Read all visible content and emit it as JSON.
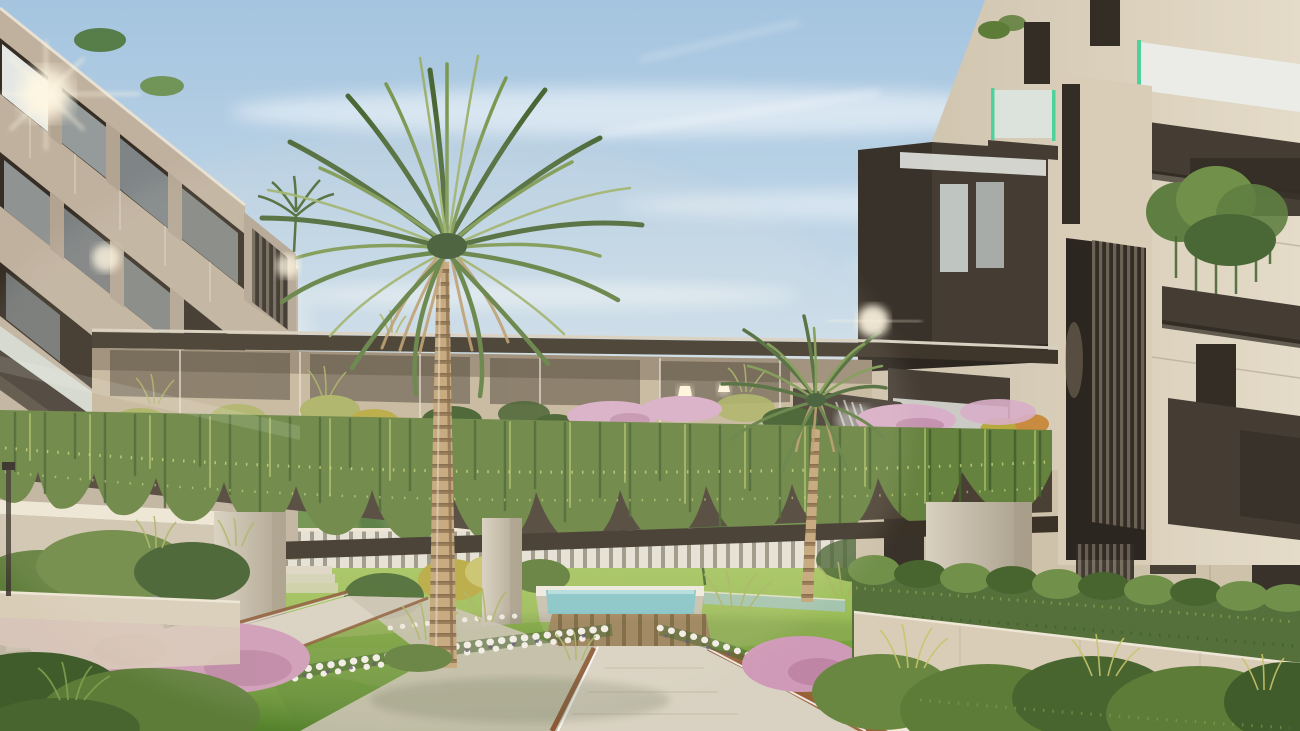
{
  "meta": {
    "type": "architectural-rendering",
    "subject": "Modern residential complex courtyard with landscaped garden, green bridge and palm trees",
    "style": "photorealistic 3D exterior visualization",
    "lighting": "warm late-afternoon sun from the left",
    "width_px": 1300,
    "height_px": 731
  },
  "scene": {
    "description": "Photorealistic rendering of a contemporary apartment development: two beige-and-charcoal buildings linked by a planted pergola bridge draped with hanging vines, a tall date palm rising through the courtyard, landscaped paths with corten-steel edging and lit borders, a turquoise water feature with timber deck, white and pink flower beds, ornamental grasses and clipped hedges.",
    "labels": {
      "sky": "Sky with wispy clouds",
      "clouds": "Cloud streaks",
      "sun_flares": "Sun glints on facades",
      "left_building": "Left apartment building",
      "left_wing": "Left single-storey wing",
      "roof_plants": "Rooftop planting",
      "bridge": "Planted pergola bridge",
      "pergola": "Pergola canopy",
      "stone_wall": "Stone feature wall behind pergola",
      "pendants": "Pendant lights",
      "bridge_planting": "Bridge planting with pink heather",
      "vines": "Hanging vine curtain",
      "soffit": "Bridge soffit",
      "pillars": "Concrete support pillars",
      "background": "Garden beyond the bridge",
      "fence": "White slatted fence",
      "trees": "Background trees",
      "steps": "Garden steps and ramp",
      "water": "Water feature",
      "deck": "Timber deck",
      "paths": "Garden paths",
      "lawn": "Lawn",
      "flowers_white": "White flower beds",
      "flowers_pink": "Pink flowering shrubs",
      "grasses": "Ornamental grasses",
      "hedge": "Clipped leafy hedge",
      "wall": "Stone planter wall",
      "right_building": "Right apartment building",
      "louvers": "Vertical louver screen",
      "balcony_plants": "Cascading balcony plants",
      "palm_main": "Central date palm",
      "palm_second": "Second palm tree",
      "palm_roof": "Rooftop palm",
      "lamp": "Garden light post",
      "shrubs": "Foreground shrubs",
      "waterfall": "Cascading water-light feature"
    }
  },
  "palette": {
    "sky_top": "#a4c4df",
    "sky_mid": "#c9dcea",
    "sky_low": "#e9e4d7",
    "sky_warm": "#f4ead9",
    "cloud": "#ffffff",
    "sun": "#fff7e2",
    "lf_base": "#bfb19e",
    "lf_panel": "#b3a492",
    "lf_light": "#d3c7b4",
    "lf_dark_win": "#362e24",
    "lf_glass_bright": "#eef1ef",
    "lf_glass_med": "#b5bfc2",
    "lf_glass_dim": "#98a3a8",
    "lf_seam": "#e8e0d2",
    "charcoal": "#453d34",
    "charcoal_dark": "#2c2620",
    "charcoal_mid": "#39322a",
    "wing_wall": "#cfc4b0",
    "wing_glass": "#b7c0ba",
    "rb_left": "#cdc1ab",
    "rb_right": "#e4dbc8",
    "rb_base": "#cec2ab",
    "rb_pier": "#d9cdb8",
    "frosted": "#eceeea",
    "glass_cool": "#dde8e6",
    "glass_green": "#4fd19b",
    "louver_light": "#6e6557",
    "louver_dark": "#332d26",
    "pergola": "#3f362b",
    "pergola_edge": "#d8d0c0",
    "stone": "#c6b79c",
    "stone_shadow": "#8d7f6b",
    "lamp_glow": "#fff6dd",
    "vine": "#66823f",
    "vine_dark": "#46622e",
    "vine_light": "#9db35f",
    "vine_speckle": "#ccd97f",
    "planter": "#4a4034",
    "soffit": "#3a3127",
    "pillar": "#d8d0c0",
    "pillar_shade": "#a89d89",
    "fence": "#e5e1d6",
    "fence_gap": "#9a9585",
    "lawn": "#7aa43c",
    "lawn_dark": "#55822c",
    "lawn_back": "#96b854",
    "lawn_back_light": "#a8c862",
    "tree": "#4e7438",
    "tree_light": "#6a8f4a",
    "tree_dark": "#3a5a2c",
    "water": "#86c6ca",
    "water_light": "#bfe4e4",
    "channel": "#a4c6bd",
    "deck": "#a8895f",
    "deck_gap": "#826740",
    "path": "#d9d2c2",
    "path_shade": "#c9c1b0",
    "path_joint": "#c7bfae",
    "coping": "#eeeade",
    "corten": "#8a5733",
    "corten_light": "#9a6136",
    "led": "#ffffff",
    "wall": "#d9cdb8",
    "wall_light": "#efe7d6",
    "hedge": "#55703a",
    "hedge_light": "#71904a",
    "hedge_dark": "#49652f",
    "hedge_hi": "#86a152",
    "shrub": "#5d7c38",
    "shrub_dark": "#3f5c2a",
    "shrub_light": "#6a8742",
    "grass_tuft": "#aab264",
    "grass_yellow": "#c9c36a",
    "bush_yellow": "#b8a93f",
    "orange": "#c98b3f",
    "pink": "#cf9ab8",
    "pink_deep": "#b27898",
    "heather": "#d8aec8",
    "flower_white": "#f2efe8",
    "flower_center": "#5f4f72",
    "trunk": "#c3a477",
    "trunk_dark": "#92744e",
    "trunk_ring": "#7e6342",
    "frond": "#5f7f42",
    "frond_dark": "#4a6836",
    "frond_light": "#7b9851",
    "frond_pale": "#9cb06a",
    "crown_core": "#3c5630",
    "skirt": "#b99a6a",
    "steps": "#ddd6c6",
    "shadow": "#2f3c22"
  }
}
